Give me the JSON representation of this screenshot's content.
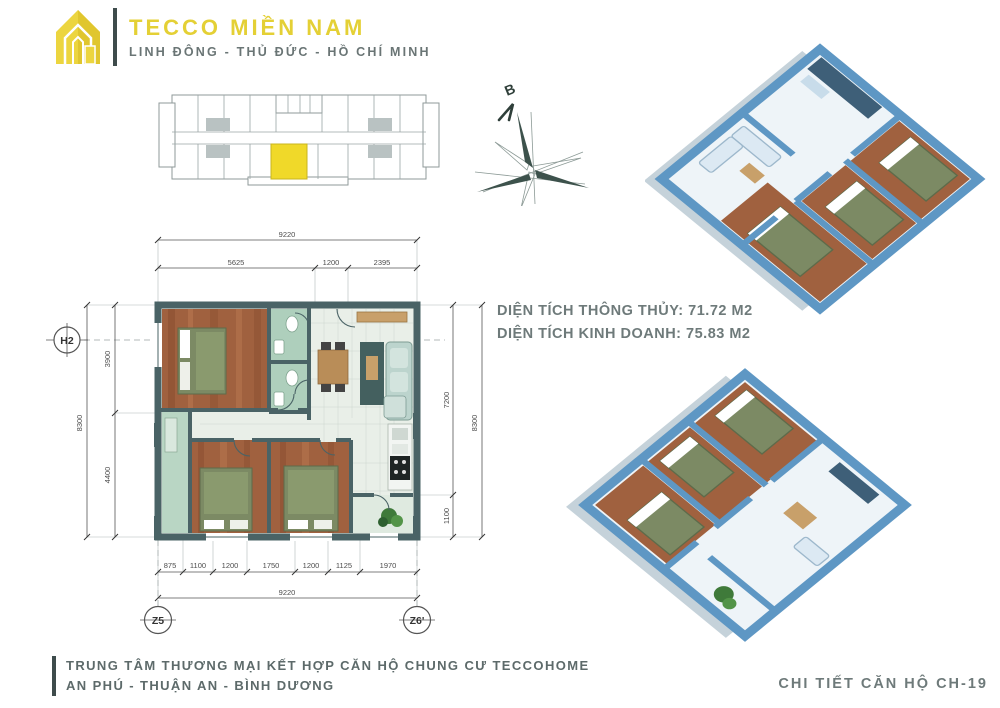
{
  "header": {
    "brand": "TECCO MIỀN NAM",
    "location": "LINH ĐÔNG - THỦ ĐỨC - HỒ CHÍ MINH"
  },
  "compass": {
    "north_label": "B"
  },
  "floor_plan": {
    "axes": {
      "left": "H2",
      "bottom_left": "Z5",
      "bottom_right": "Z6'"
    },
    "dims": {
      "top_overall": "9220",
      "top_segments": [
        "5625",
        "1200",
        "2395"
      ],
      "bottom_segments": [
        "875",
        "1100",
        "1200",
        "1750",
        "1200",
        "1125",
        "1970"
      ],
      "bottom_overall": "9220",
      "left_overall": "8300",
      "left_segments": [
        "3900",
        "4400"
      ],
      "right_segments": [
        "7200",
        "1100"
      ],
      "right_overall": "8300"
    }
  },
  "areas": {
    "net_label": "DIỆN TÍCH THÔNG THỦY:",
    "net_value": "71.72 M2",
    "gross_label": "DIỆN TÍCH KINH DOANH:",
    "gross_value": "75.83 M2"
  },
  "footer": {
    "project_line1": "TRUNG TÂM THƯƠNG MẠI KẾT HỢP CĂN HỘ CHUNG CƯ TECCOHOME",
    "project_line2": "AN PHÚ - THUẬN AN - BÌNH DƯƠNG",
    "unit_detail": "CHI TIẾT CĂN HỘ CH-19"
  },
  "colors": {
    "brand_yellow": "#e4d035",
    "text_gray": "#6e7a7a",
    "wall_teal": "#4a6366",
    "wood_floor": "#a0613f",
    "bath_green": "#aecfbc",
    "floor_light": "#e9efe8",
    "render_blue": "#5e97c4",
    "unit_highlight": "#f0d929"
  }
}
